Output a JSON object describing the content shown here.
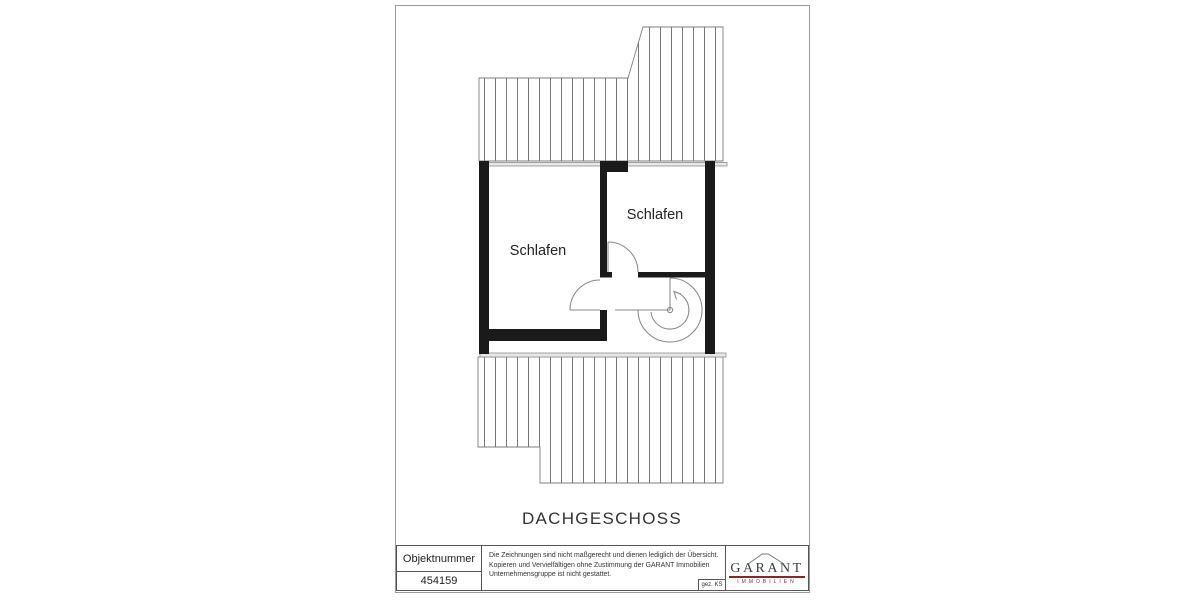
{
  "plan": {
    "floor_label": "DACHGESCHOSS",
    "rooms": [
      {
        "label": "Schlafen"
      },
      {
        "label": "Schlafen"
      }
    ]
  },
  "title_block": {
    "object_number_label": "Objektnummer",
    "object_number_value": "454159",
    "disclaimer_lines": [
      "Die Zeichnungen sind nicht maßgerecht und dienen lediglich der Übersicht.",
      "Kopieren und Vervielfältigen ohne Zustimmung der GARANT Immobilien",
      "Unternehmensgruppe ist nicht gestattet."
    ],
    "drawn_by": "gez. KS",
    "logo": {
      "name": "GARANT",
      "subtitle": "IMMOBILIEN"
    }
  },
  "colors": {
    "wall": "#1a1a1a",
    "line": "#8a8a8a",
    "hatch": "#666666",
    "text": "#2b2b2b",
    "border": "#9a9a9a",
    "logored": "#8e2525"
  }
}
